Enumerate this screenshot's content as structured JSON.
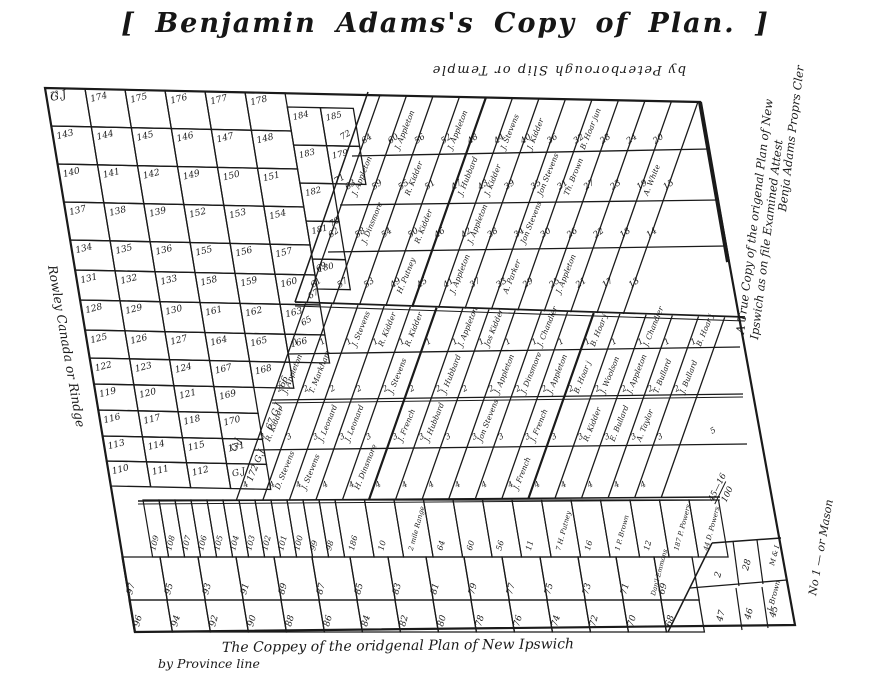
{
  "page": {
    "title": "[ Benjamin Adams's Copy of Plan. ]",
    "ink": "#1a1a1a",
    "paper": "#ffffff"
  },
  "annotations": {
    "top": "by Peterborough Slip or Temple",
    "left": "Rowley Canada or Rindge",
    "right1": "A True Copy of the origenal Plan of New",
    "right2": "Ipswich as on file Examined  Attest",
    "right3": "Benja Adams Proprs Cler",
    "corner": "No 1 — or Mason",
    "caption1": "The Coppey of the oridgenal Plan of New Ipswich",
    "caption2": "by Province line",
    "fraction_num": "45—16",
    "fraction_den": "100"
  },
  "left_grid": {
    "rows": [
      [
        "G.J",
        "174",
        "175",
        "176",
        "177",
        "178",
        "184",
        "185"
      ],
      [
        "143",
        "144",
        "145",
        "146",
        "147",
        "148",
        "183",
        "179"
      ],
      [
        "140",
        "141",
        "142",
        "149",
        "150",
        "151",
        "182"
      ],
      [
        "137",
        "138",
        "139",
        "152",
        "153",
        "154",
        "181"
      ],
      [
        "134",
        "135",
        "136",
        "155",
        "156",
        "157",
        "180"
      ],
      [
        "131",
        "132",
        "133",
        "158",
        "159",
        "160"
      ],
      [
        "128",
        "129",
        "130",
        "161",
        "162",
        "163"
      ],
      [
        "125",
        "126",
        "127",
        "164",
        "165",
        "166"
      ],
      [
        "122",
        "123",
        "124",
        "167",
        "168"
      ],
      [
        "119",
        "120",
        "121",
        "169"
      ],
      [
        "116",
        "117",
        "118",
        "170"
      ],
      [
        "113",
        "114",
        "115",
        "171"
      ],
      [
        "110",
        "111",
        "112",
        "G.J"
      ]
    ],
    "wedge": [
      [
        "66",
        284,
        388
      ],
      [
        "67 G.J",
        271,
        430
      ],
      [
        "172 G.J",
        252,
        482
      ],
      [
        "G.J",
        236,
        452
      ]
    ]
  },
  "upper_band": {
    "edge": [
      [
        "72",
        342,
        140
      ],
      [
        "71",
        336,
        184
      ],
      [
        "70",
        331,
        227
      ],
      [
        "69",
        318,
        272
      ],
      [
        "67",
        310,
        299
      ],
      [
        "65",
        303,
        326
      ]
    ],
    "tiers": [
      [
        "64",
        "60",
        "56",
        "52",
        "48",
        "44",
        "40",
        "36",
        "32",
        "28",
        "24",
        "20"
      ],
      [
        "63",
        "59",
        "55",
        "51",
        "47",
        "43",
        "39",
        "35",
        "31",
        "27",
        "23",
        "19",
        "15"
      ],
      [
        "62",
        "58",
        "54",
        "50",
        "46",
        "42",
        "38",
        "34",
        "30",
        "26",
        "22",
        "18",
        "14"
      ],
      [
        "61",
        "57",
        "53",
        "49",
        "45",
        "41",
        "37",
        "33",
        "29",
        "25",
        "21",
        "17",
        "13"
      ]
    ],
    "names": [
      [
        0,
        1,
        "J. Appleton"
      ],
      [
        0,
        3,
        "J. Appleton"
      ],
      [
        0,
        5,
        "J. Stevens"
      ],
      [
        0,
        6,
        "J. Kidder"
      ],
      [
        0,
        8,
        "B. Hoar jun"
      ],
      [
        1,
        0,
        "J. Appleton"
      ],
      [
        1,
        2,
        "R. Kidder"
      ],
      [
        1,
        4,
        "J. Hubbard"
      ],
      [
        1,
        5,
        "J. Kidder"
      ],
      [
        1,
        7,
        "Jon Stevens"
      ],
      [
        1,
        8,
        "Th. Brown"
      ],
      [
        1,
        11,
        "A. White"
      ],
      [
        2,
        1,
        "J. Dinsmore"
      ],
      [
        2,
        3,
        "R. Kidder"
      ],
      [
        2,
        5,
        "J. Appleton"
      ],
      [
        2,
        7,
        "Jon Stevens"
      ],
      [
        3,
        3,
        "H. Putney"
      ],
      [
        3,
        5,
        "J. Appleton"
      ],
      [
        3,
        7,
        "A. Parker"
      ],
      [
        3,
        9,
        "J. Appleton"
      ]
    ]
  },
  "middle_band": {
    "tier_marks": [
      "1",
      "2",
      "3",
      "4"
    ],
    "names": [
      [
        0,
        2,
        "J. Stevens"
      ],
      [
        0,
        3,
        "R. Kidder"
      ],
      [
        0,
        4,
        "R. Kidder"
      ],
      [
        0,
        6,
        "J. Appleton"
      ],
      [
        0,
        7,
        "Jos Kidder"
      ],
      [
        0,
        9,
        "J. Chandler"
      ],
      [
        0,
        11,
        "B. Hoar j"
      ],
      [
        0,
        13,
        "J. Chandler"
      ],
      [
        0,
        15,
        "B. Hoar j"
      ],
      [
        1,
        0,
        "J. Appleton"
      ],
      [
        1,
        1,
        "T. Markham"
      ],
      [
        1,
        4,
        "J. Stevens"
      ],
      [
        1,
        6,
        "J. Hubbard"
      ],
      [
        1,
        8,
        "J. Appleton"
      ],
      [
        1,
        9,
        "J. Dinsmore"
      ],
      [
        1,
        10,
        "J. Appleton"
      ],
      [
        1,
        11,
        "B. Hoar j"
      ],
      [
        1,
        12,
        "J. Woolson"
      ],
      [
        1,
        13,
        "J. Appleton"
      ],
      [
        1,
        14,
        "T. Bullard"
      ],
      [
        1,
        15,
        "J. Bullard"
      ],
      [
        2,
        0,
        "R. Kidder"
      ],
      [
        2,
        2,
        "J. Leonard"
      ],
      [
        2,
        3,
        "J. Leonard"
      ],
      [
        2,
        5,
        "J. French"
      ],
      [
        2,
        6,
        "J. Hubbard"
      ],
      [
        2,
        8,
        "Jon Stevens"
      ],
      [
        2,
        10,
        "J. French"
      ],
      [
        2,
        12,
        "R. Kidder"
      ],
      [
        2,
        13,
        "E. Bullard"
      ],
      [
        2,
        14,
        "A. Taylor"
      ],
      [
        3,
        1,
        "D. Stevens"
      ],
      [
        3,
        2,
        "J. Stevens"
      ],
      [
        3,
        4,
        "H. Dinsmore"
      ],
      [
        3,
        10,
        "J. French"
      ]
    ]
  },
  "bottom": {
    "slips": [
      "109",
      "108",
      "107",
      "106",
      "105",
      "104",
      "103",
      "102",
      "101",
      "100",
      "99",
      "98",
      "186",
      "10",
      "2 mile Range",
      "64",
      "60",
      "56",
      "11",
      "7 H. Putney",
      "16",
      "1 P. Brown",
      "12",
      "187 P. Powers",
      "44 D. Powers"
    ],
    "row_a": [
      "97",
      "95",
      "93",
      "91",
      "89",
      "87",
      "85",
      "83",
      "81",
      "79",
      "77",
      "75",
      "73",
      "71",
      "69"
    ],
    "row_b": [
      "96",
      "94",
      "92",
      "90",
      "88",
      "86",
      "84",
      "82",
      "80",
      "78",
      "76",
      "74",
      "72",
      "70",
      "68"
    ],
    "right_top": [
      "2",
      "28",
      "M & I"
    ],
    "right_bottom": [
      "47",
      "46",
      "45"
    ],
    "extras": [
      [
        "Dan'l Emmons",
        655,
        596,
        -75,
        6.5
      ],
      [
        "J. Brown",
        772,
        612,
        -75,
        7.5
      ],
      [
        "5",
        712,
        434,
        -30,
        8
      ],
      [
        "73",
        51,
        97,
        -15,
        6.5
      ]
    ]
  }
}
